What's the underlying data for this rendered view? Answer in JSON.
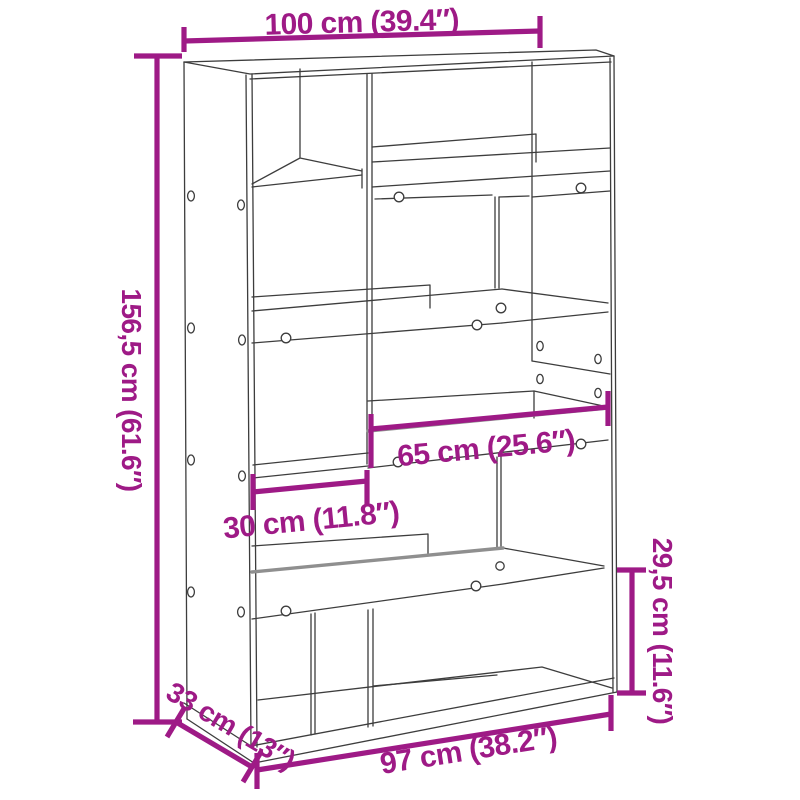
{
  "product": {
    "type_label": "bookcase-room-divider-diagram"
  },
  "colors": {
    "background": "#FFFFFF",
    "accent": "#9E1A86",
    "line": "#3D3D3D",
    "line_soft": "#8F8F8F"
  },
  "dimensions": {
    "width_top": {
      "label": "100 cm (39.4″)",
      "orientation": "horizontal-top"
    },
    "height_left": {
      "label": "156,5 cm (61.6″)",
      "orientation": "vertical-left"
    },
    "shelf_width_right": {
      "label": "65 cm (25.6″)",
      "orientation": "horizontal-middle"
    },
    "shelf_width_left": {
      "label": "30 cm (11.8″)",
      "orientation": "horizontal-middle-left"
    },
    "depth": {
      "label": "33 cm (13″)",
      "orientation": "diagonal-bottom-left"
    },
    "width_bottom": {
      "label": "97 cm (38.2″)",
      "orientation": "horizontal-bottom"
    },
    "compartment_height_right": {
      "label": "29,5 cm (11.6″)",
      "orientation": "vertical-right"
    }
  }
}
